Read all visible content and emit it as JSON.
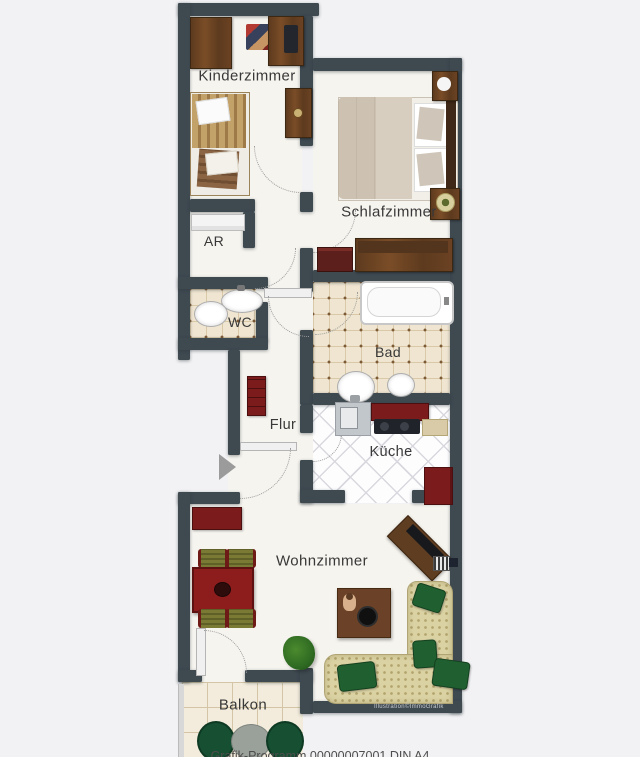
{
  "page": {
    "background": "#f2f2f4",
    "caption_partial": "Grafik-Programm 00000007001 DIN A4"
  },
  "plan": {
    "credit": "Illustration©ImmoGrafik",
    "rooms": [
      {
        "id": "kinderzimmer",
        "label": "Kinderzimmer"
      },
      {
        "id": "schlafzimmer",
        "label": "Schlafzimmer"
      },
      {
        "id": "abstellraum",
        "label": "AR"
      },
      {
        "id": "wc",
        "label": "WC"
      },
      {
        "id": "bad",
        "label": "Bad"
      },
      {
        "id": "flur",
        "label": "Flur"
      },
      {
        "id": "kueche",
        "label": "Küche"
      },
      {
        "id": "wohnzimmer",
        "label": "Wohnzimmer"
      },
      {
        "id": "balkon",
        "label": "Balkon"
      }
    ],
    "icons": {
      "entrance_arrow": "entrance-arrow"
    },
    "colors": {
      "wall": "#3e4950",
      "floor": "#f6f4ef",
      "bath_tile": "#efe5d0",
      "kitchen_tile": "#fdfdfe",
      "balcony_tile": "#f3ecdc",
      "accent_red": "#7c1b1b",
      "wood": "#6b4426",
      "sofa_beige": "#dbd2a4",
      "pillow_green": "#206030"
    }
  }
}
